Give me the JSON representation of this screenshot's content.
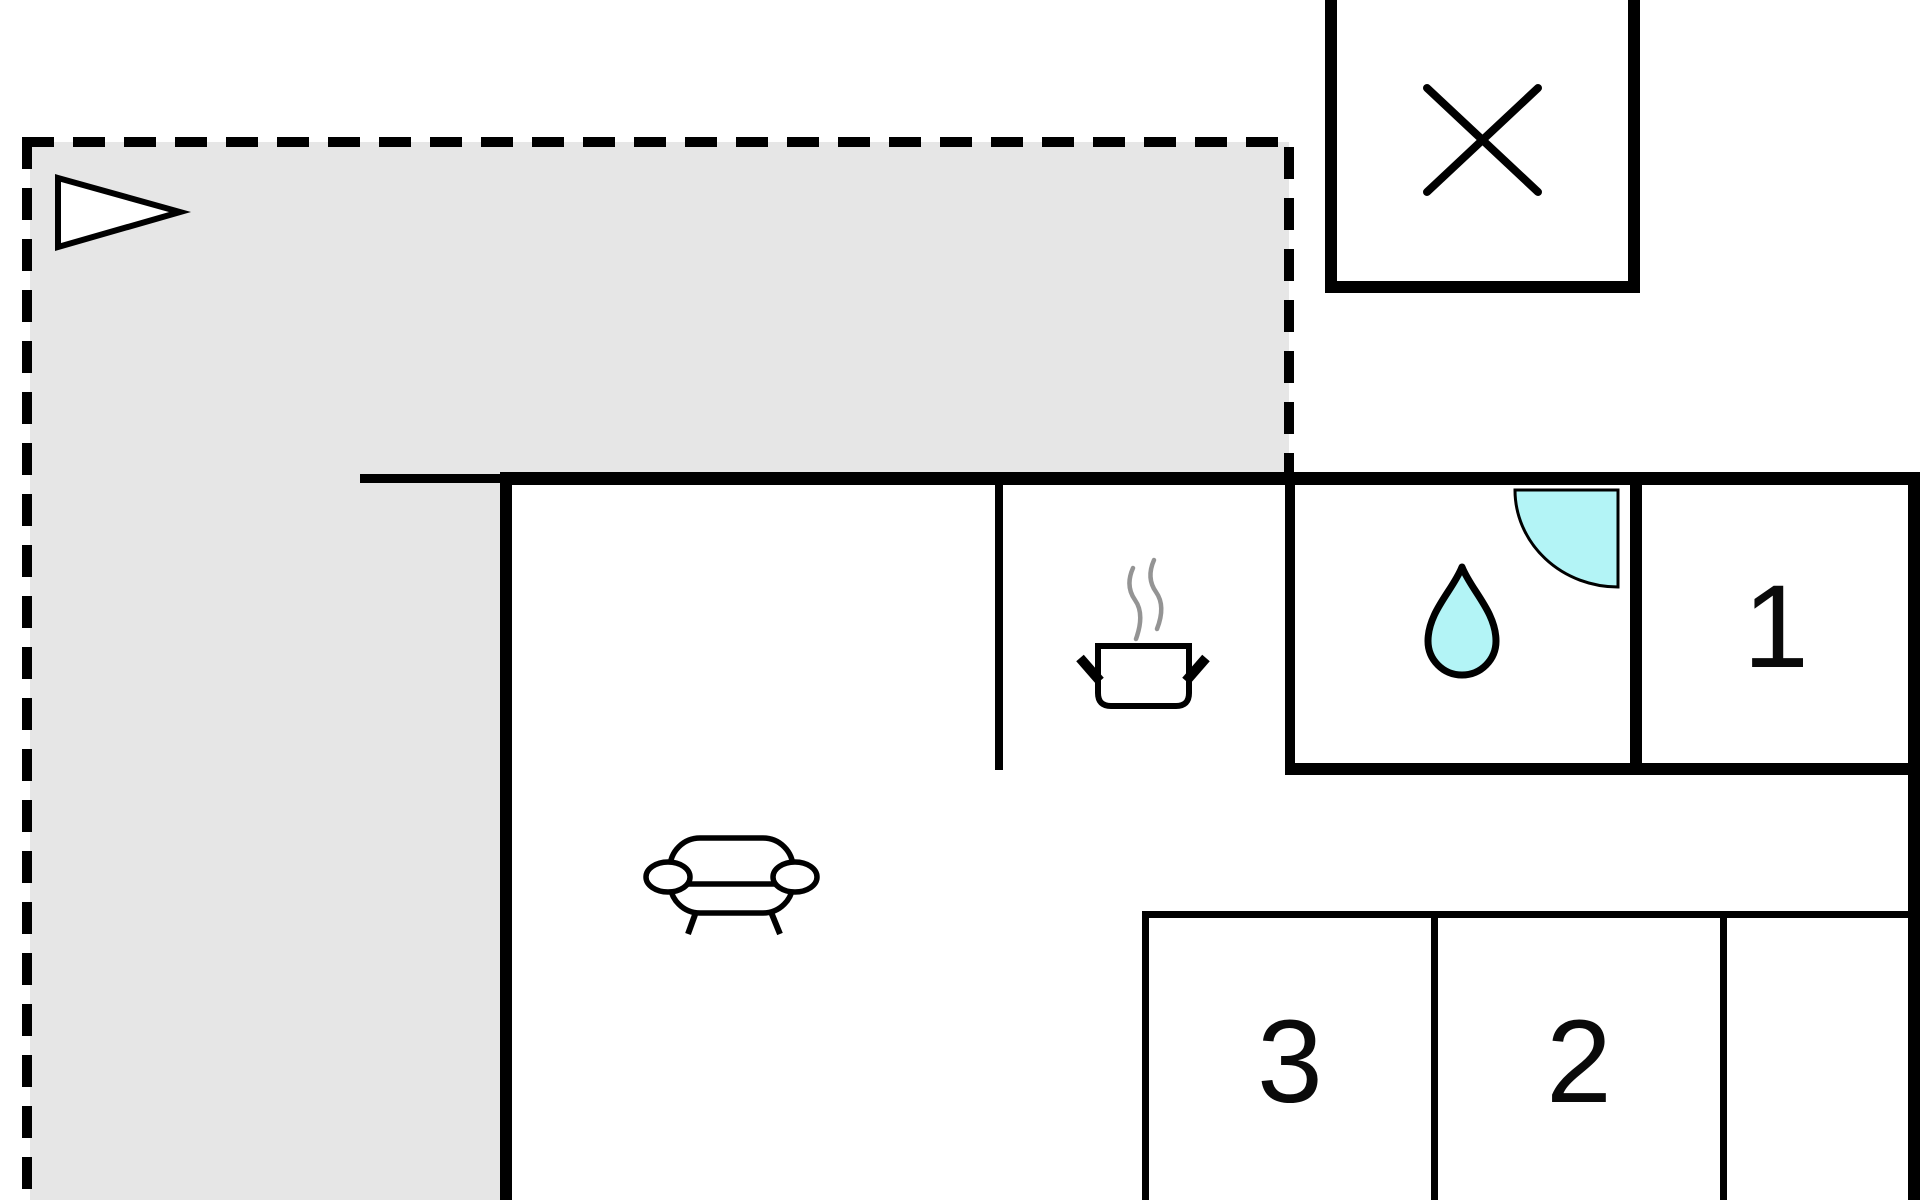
{
  "floor_plan": {
    "description": "Holiday home floor plan with terrace, kitchen, bathroom, living area and three numbered rooms",
    "room_labels": {
      "room1": "1",
      "room2": "2",
      "room3": "3"
    },
    "icons": {
      "direction_arrow": "white triangle pointing right on terrace",
      "x_box": "square annex marked with diagonal cross",
      "cooking_pot": "steaming cooking pot marking the kitchen",
      "water_drop": "water drop marking the bathroom",
      "shower": "quarter-circle shower corner in bathroom",
      "sofa": "sofa marking the living area"
    },
    "colors": {
      "wall": "#000000",
      "terrace_fill": "#e6e6e6",
      "water_fill": "#b3f4f6",
      "steam": "#949494",
      "icon_fill": "#ffffff",
      "background": "#ffffff"
    }
  }
}
